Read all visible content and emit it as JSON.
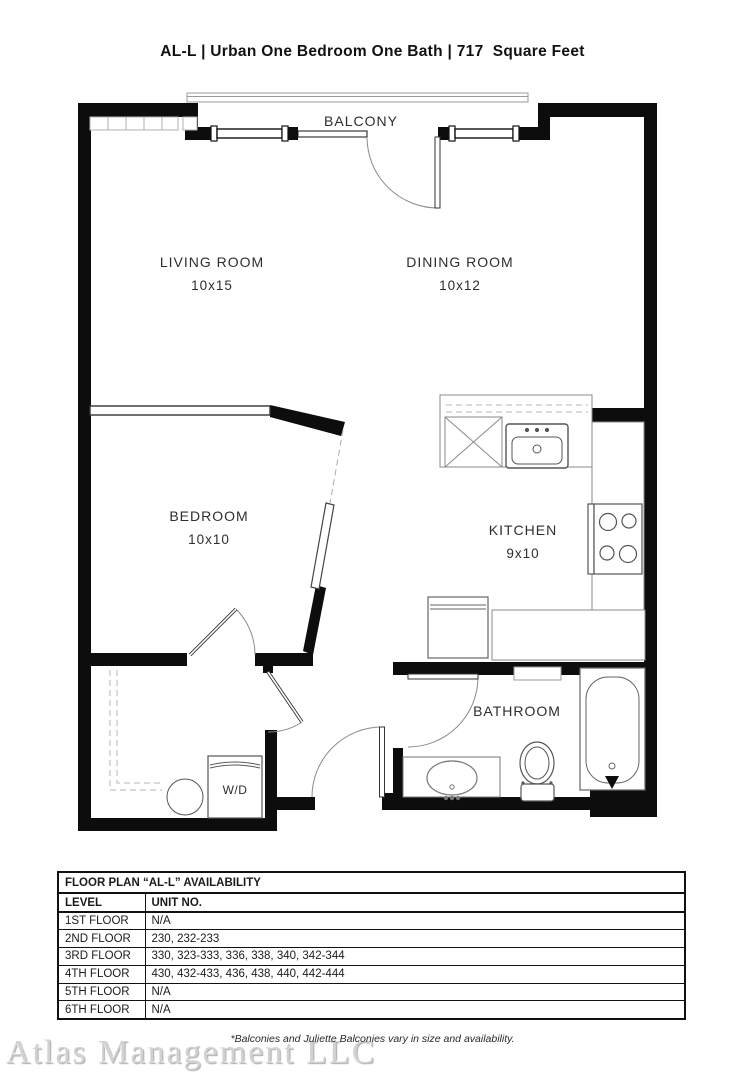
{
  "page": {
    "title": "AL-L | Urban One Bedroom One Bath | 717  Square Feet",
    "footnote": "*Balconies and Juliette Balconies vary in size and availability.",
    "watermark": "Atlas Management LLC"
  },
  "floorplan": {
    "rooms": {
      "balcony": {
        "label": "BALCONY"
      },
      "living": {
        "label": "LIVING ROOM",
        "dims": "10x15"
      },
      "dining": {
        "label": "DINING ROOM",
        "dims": "10x12"
      },
      "bedroom": {
        "label": "BEDROOM",
        "dims": "10x10"
      },
      "kitchen": {
        "label": "KITCHEN",
        "dims": "9x10"
      },
      "bathroom": {
        "label": "BATHROOM"
      },
      "laundry": {
        "label": "W/D"
      }
    },
    "colors": {
      "wall": "#0d0d0d",
      "fixture_line": "#8a8a8a",
      "label_text": "#2e2e2e"
    }
  },
  "availability_table": {
    "title": "FLOOR PLAN “AL-L” AVAILABILITY",
    "columns": [
      "LEVEL",
      "UNIT NO."
    ],
    "rows": [
      {
        "level": "1ST FLOOR",
        "units": "N/A"
      },
      {
        "level": "2ND FLOOR",
        "units": "230, 232-233"
      },
      {
        "level": "3RD FLOOR",
        "units": "330, 323-333, 336, 338, 340, 342-344"
      },
      {
        "level": "4TH FLOOR",
        "units": "430, 432-433, 436, 438, 440, 442-444"
      },
      {
        "level": "5TH FLOOR",
        "units": "N/A"
      },
      {
        "level": "6TH FLOOR",
        "units": "N/A"
      }
    ]
  }
}
